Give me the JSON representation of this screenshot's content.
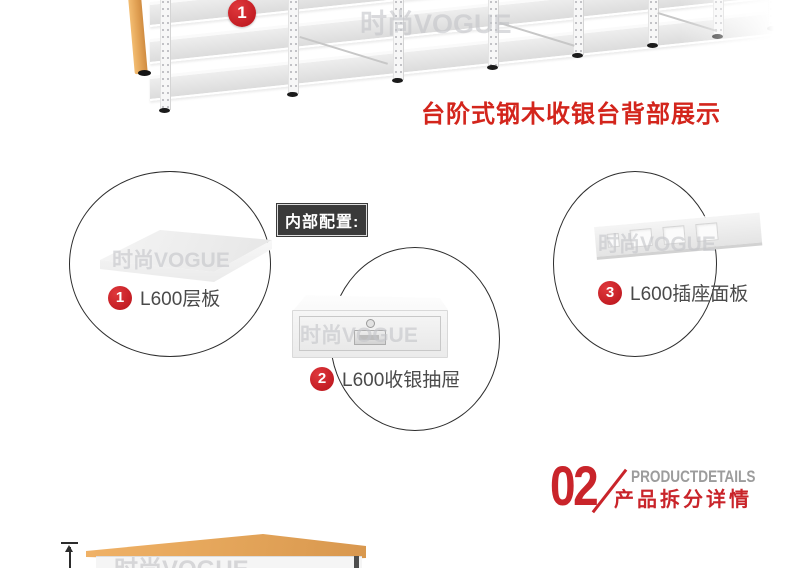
{
  "page_background": "#ffffff",
  "colors": {
    "accent_red": "#c9242a",
    "caption_red": "#d3251c",
    "label_gray": "#4a4a4a",
    "config_box_bg": "#3a3a3a",
    "wood": "#e5a55c",
    "watermark_gray": "#c5c6ca"
  },
  "watermark": "时尚VOGUE",
  "back_view": {
    "badge": "1",
    "caption": "台阶式钢木收银台背部展示"
  },
  "config_box": {
    "label": "内部配置:"
  },
  "callouts": [
    {
      "badge": "1",
      "label": "L600层板",
      "image": "shelf-board"
    },
    {
      "badge": "2",
      "label": "L600收银抽屉",
      "image": "cash-drawer"
    },
    {
      "badge": "3",
      "label": "L600插座面板",
      "image": "socket-panel"
    }
  ],
  "section": {
    "number": "02",
    "title_en": "PRODUCTDETAILS",
    "title_cn": "产品拆分详情"
  }
}
